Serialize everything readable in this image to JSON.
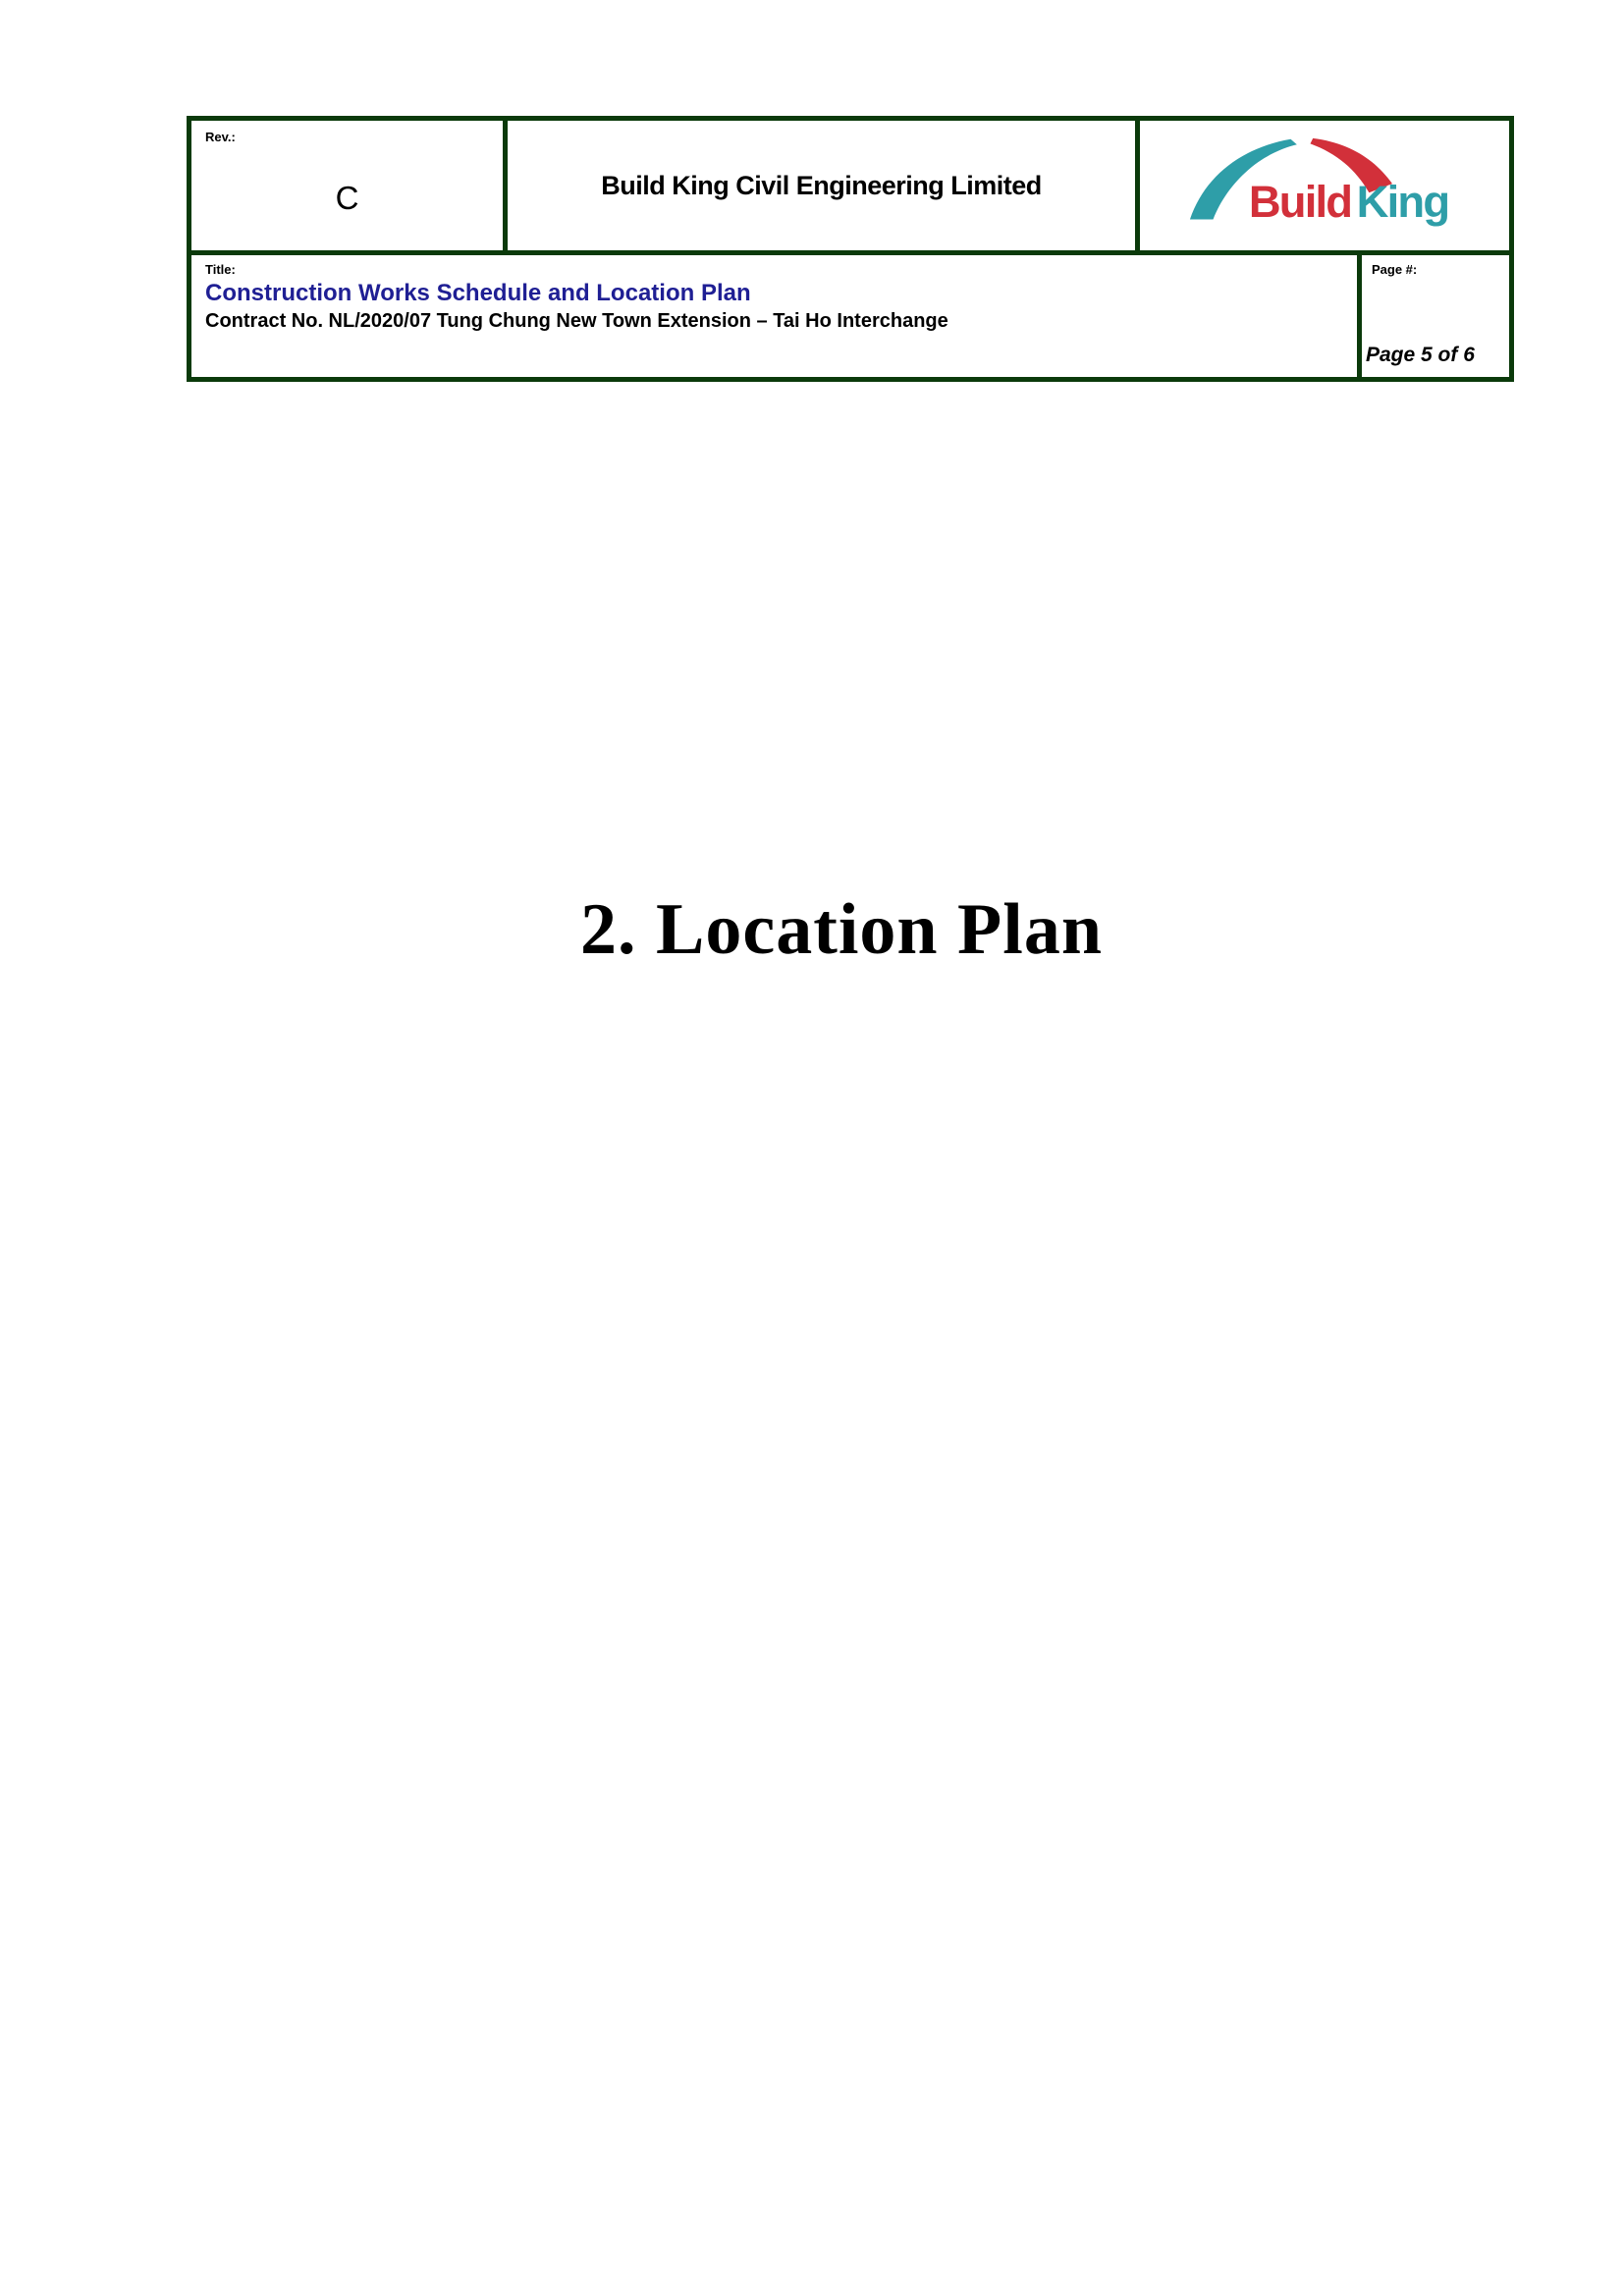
{
  "header": {
    "rev_label": "Rev.:",
    "rev_value": "C",
    "company_name": "Build King Civil Engineering Limited",
    "title_label": "Title:",
    "doc_title": "Construction Works Schedule and Location Plan",
    "contract_line": "Contract No. NL/2020/07 Tung Chung New Town Extension – Tai Ho Interchange",
    "page_label": "Page #:",
    "page_value": "Page 5 of 6"
  },
  "logo": {
    "text_build": "Build",
    "text_king": "King",
    "color_red": "#D2303A",
    "color_teal": "#2E9EA8"
  },
  "body": {
    "section_heading": "2. Location Plan"
  },
  "colors": {
    "table_border_green": "#0B3A0B",
    "doc_title_blue": "#1F1F94"
  }
}
